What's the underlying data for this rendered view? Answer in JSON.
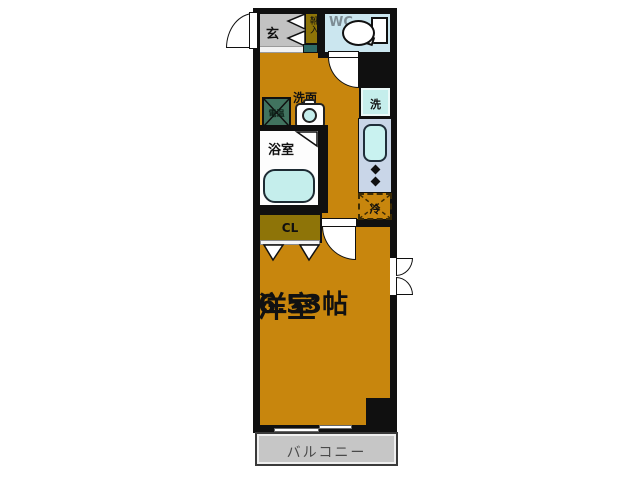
{
  "floorplan": {
    "type": "apartment-floorplan",
    "labels": {
      "entrance": "玄",
      "shoe_cabinet": "靴入",
      "toilet_room": "WC",
      "water_heater": "電温",
      "washbasin": "洗面",
      "bathroom": "浴室",
      "washer": "洗",
      "refrigerator": "冷",
      "closet": "CL",
      "room_name": "洋室",
      "room_size": "6.53帖",
      "balcony": "バルコニー"
    },
    "colors": {
      "floor_orange": "#c8860d",
      "wall_black": "#101010",
      "entrance_gray": "#c2c2c2",
      "wc_blue": "#cbe6ef",
      "fixture_cyan": "#c5eeec",
      "kitchen_counter_blue": "#c9d6e8",
      "cabinet_olive": "#8e7408",
      "water_heater_green": "#41735f",
      "balcony_gray": "#c6c6c6"
    }
  }
}
